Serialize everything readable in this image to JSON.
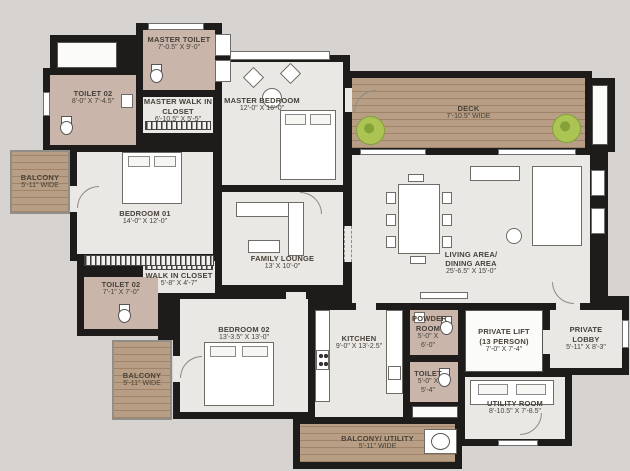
{
  "colors": {
    "bg": "#d6d3d0",
    "wall": "#1e1c1a",
    "floor": "#eae8e4",
    "bath": "#c9b5aa",
    "wood": "#b89e85",
    "tree": "#abc454"
  },
  "plan": {
    "rooms": [
      {
        "name": "TOILET 02",
        "dims": "8'-0\" X 7'-4.5\""
      },
      {
        "name": "MASTER TOILET",
        "dims": "7'-0.5\" X 9'-0\""
      },
      {
        "name": "MASTER WALK IN CLOSET",
        "dims": "6'-10.5\" X 5'-5\""
      },
      {
        "name": "MASTER BEDROOM",
        "dims": "12'-0\" X 16'-0\""
      },
      {
        "name": "DECK",
        "dims": "7'-10.5\" WIDE"
      },
      {
        "name": "BALCONY",
        "dims": "5'-11\" WIDE"
      },
      {
        "name": "BEDROOM 01",
        "dims": "14'-0\" X 12'-0\""
      },
      {
        "name": "FAMILY LOUNGE",
        "dims": "13' X 10'-0\""
      },
      {
        "name": "LIVING AREA/ DINING AREA",
        "dims": "25'-6.5\" X 15'-0\""
      },
      {
        "name": "WALK IN CLOSET",
        "dims": "5'-8\" X 4'-7\""
      },
      {
        "name": "TOILET 02",
        "dims": "7'-1\" X 7'-0\""
      },
      {
        "name": "BALCONY",
        "dims": "5'-11\" WIDE"
      },
      {
        "name": "BEDROOM 02",
        "dims": "13'-3.5\" X 13'-0\""
      },
      {
        "name": "KITCHEN",
        "dims": "9'-0\" X 13'-2.5\""
      },
      {
        "name": "POWDER ROOM",
        "dims": "5'-0\" X 6'-0\""
      },
      {
        "name": "TOILET",
        "dims": "5'-0\" X 5'-4\""
      },
      {
        "name": "PRIVATE LIFT (13 PERSON)",
        "dims": "7'-0\" X 7'-4\""
      },
      {
        "name": "PRIVATE LOBBY",
        "dims": "5'-11\" X 8'-3\""
      },
      {
        "name": "UTILITY ROOM",
        "dims": "8'-10.5\" X 7'-8.5\""
      },
      {
        "name": "BALCONY/ UTILITY",
        "dims": "5'-11\" WIDE"
      }
    ]
  }
}
